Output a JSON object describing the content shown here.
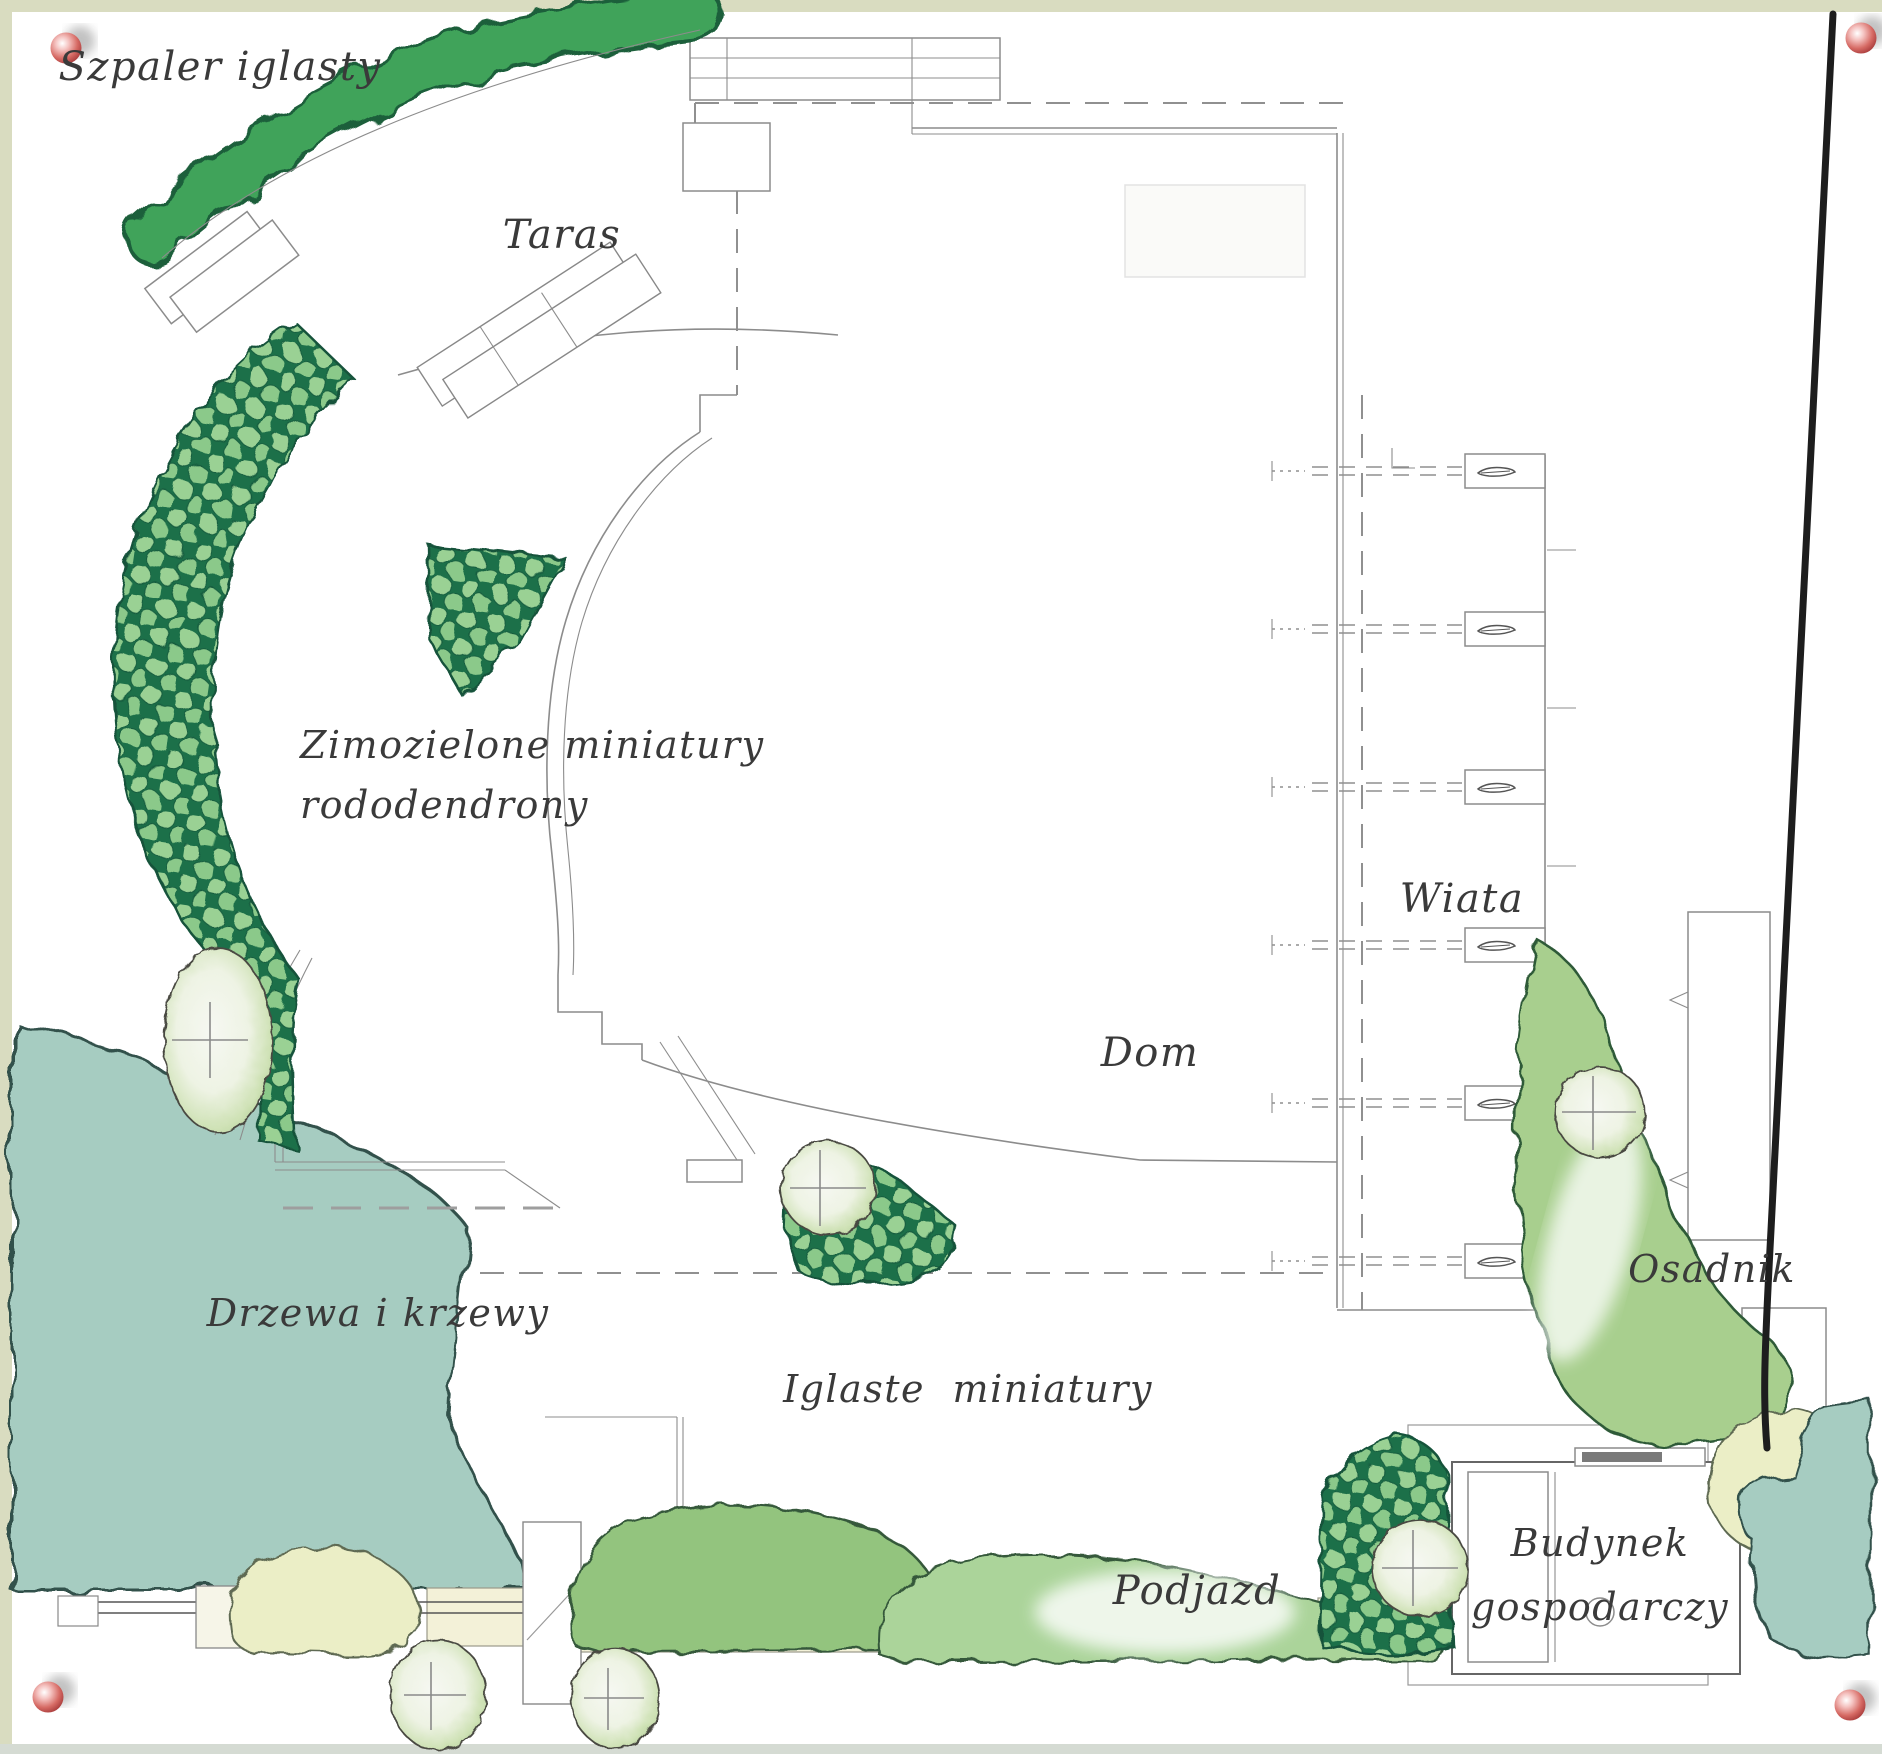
{
  "labels": {
    "szpaler": "Szpaler iglasty",
    "taras": "Taras",
    "zimozielone_1": "Zimozielone miniatury",
    "zimozielone_2": "rododendrony",
    "wiata": "Wiata",
    "dom": "Dom",
    "drzewa": "Drzewa i krzewy",
    "iglaste": "Iglaste miniatury",
    "osadnik": "Osadnik",
    "podjazd": "Podjazd",
    "budynek_1": "Budynek",
    "budynek_2": "gospodarczy"
  },
  "colors": {
    "paper": "#ffffff",
    "border-strip": "#d9dcc0",
    "border-strip-bottom": "#d5dbd3",
    "hedge-green": "#3fa35a",
    "hedge-outline": "#1b5e3a",
    "rhodo-dark": "#1e7049",
    "rhodo-dot": "#9ad194",
    "rhodo-dot2": "#8bc98a",
    "teal": "#a6ccc1",
    "teal-outline": "#33514b",
    "shrub-green": "#93c47e",
    "shrub-light": "#abd49a",
    "shrub-outline": "#35593a",
    "band-green": "#a8cf8e",
    "yellow-shrub": "#ebeec6",
    "yellow-outline": "#5f6b52",
    "pale-tree": "#eef3e4",
    "pale-tree-rim": "#cfe2b6",
    "beige-path": "#f3f1d8",
    "line-gray": "#8c8c8c",
    "dark-line": "#1d1d1d",
    "label": "#3a3a3a",
    "pin-light": "#f5c4c2",
    "pin-mid": "#d66a64",
    "pin-dark": "#a93c3c"
  }
}
